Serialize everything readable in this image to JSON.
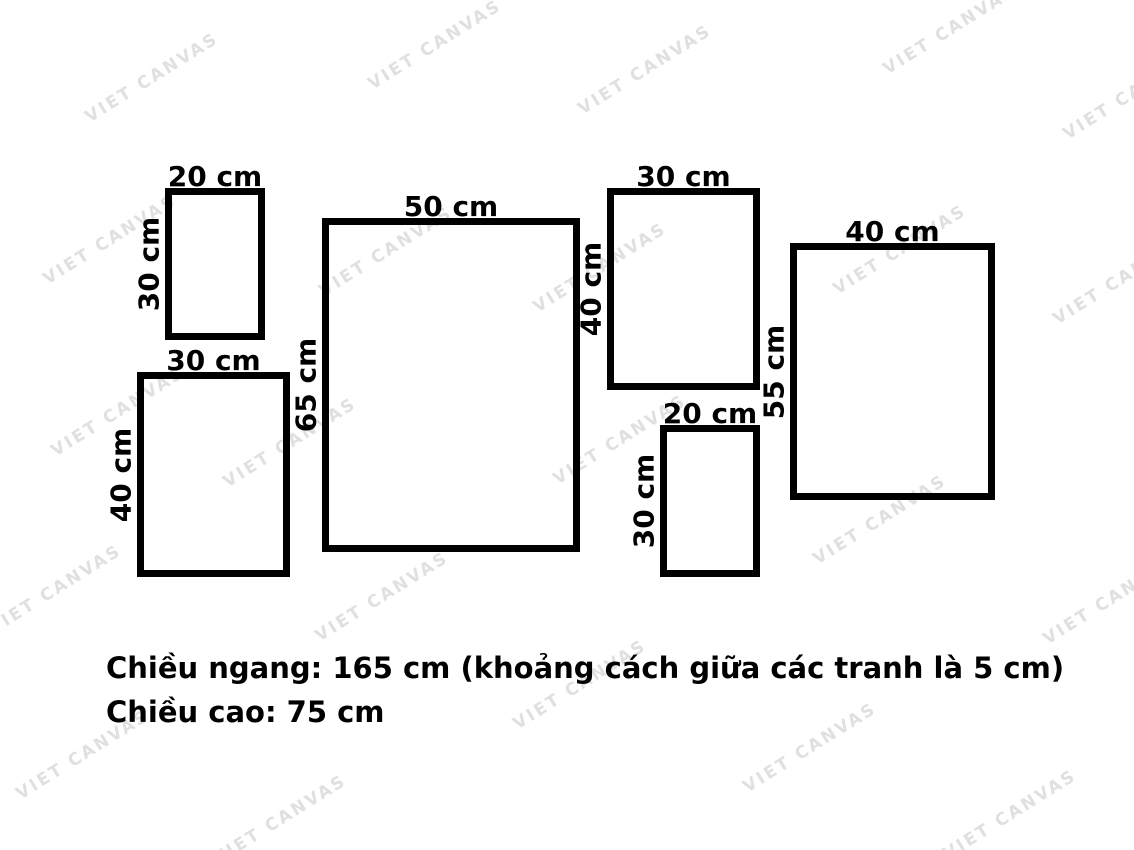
{
  "watermark": {
    "text": "VIET CANVAS"
  },
  "frames": [
    {
      "name": "frame-20x30-top-left",
      "width_label": "20 cm",
      "height_label": "30 cm"
    },
    {
      "name": "frame-30x40-bottom-left",
      "width_label": "30 cm",
      "height_label": "40 cm"
    },
    {
      "name": "frame-50x65-center",
      "width_label": "50 cm",
      "height_label": "65 cm"
    },
    {
      "name": "frame-30x40-top-middle",
      "width_label": "30 cm",
      "height_label": "40 cm"
    },
    {
      "name": "frame-20x30-bottom-middle",
      "width_label": "20 cm",
      "height_label": "30 cm"
    },
    {
      "name": "frame-40x55-right",
      "width_label": "40 cm",
      "height_label": "55 cm"
    }
  ],
  "caption": {
    "line1": "Chiều ngang: 165 cm (khoảng cách giữa các tranh là 5 cm)",
    "line2": "Chiều cao: 75 cm"
  },
  "colors": {
    "stroke": "#000000",
    "text": "#000000",
    "watermark": "#e0e0e0",
    "background": "#ffffff"
  }
}
